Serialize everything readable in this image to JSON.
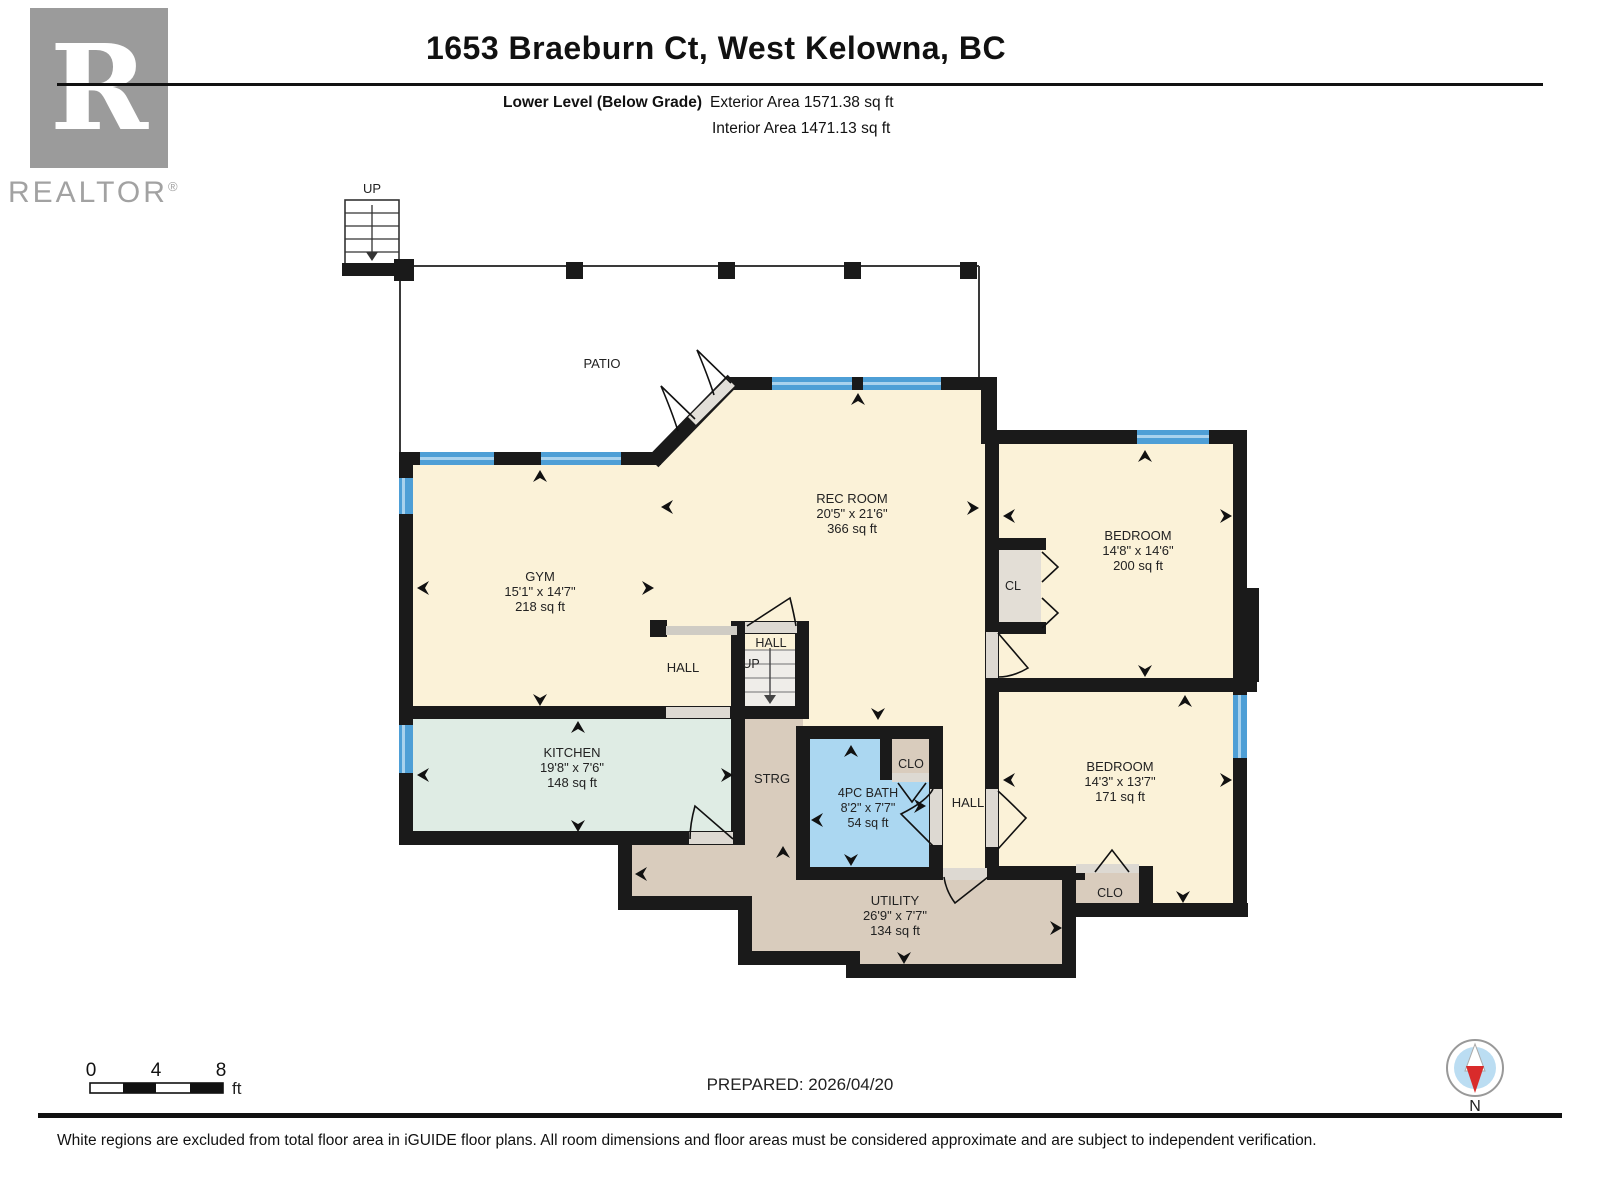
{
  "header": {
    "title": "1653 Braeburn Ct, West Kelowna, BC",
    "level": "Lower Level (Below Grade)",
    "exterior": "Exterior Area 1571.38 sq ft",
    "interior": "Interior Area 1471.13 sq ft"
  },
  "logo": {
    "letter": "R",
    "brand": "REALTOR",
    "registered": "®"
  },
  "plan": {
    "patio": "PATIO",
    "gym": {
      "name": "GYM",
      "dims": "15'1\" x 14'7\"",
      "area": "218 sq ft"
    },
    "rec": {
      "name": "REC ROOM",
      "dims": "20'5\" x 21'6\"",
      "area": "366 sq ft"
    },
    "kitchen": {
      "name": "KITCHEN",
      "dims": "19'8\" x 7'6\"",
      "area": "148 sq ft"
    },
    "bath": {
      "name": "4PC BATH",
      "dims": "8'2\" x 7'7\"",
      "area": "54 sq ft"
    },
    "bedroom1": {
      "name": "BEDROOM",
      "dims": "14'8\" x 14'6\"",
      "area": "200 sq ft"
    },
    "bedroom2": {
      "name": "BEDROOM",
      "dims": "14'3\" x 13'7\"",
      "area": "171 sq ft"
    },
    "utility": {
      "name": "UTILITY",
      "dims": "26'9\" x 7'7\"",
      "area": "134 sq ft"
    },
    "labels": {
      "hall_main": "HALL",
      "hall_stairs": "HALL",
      "hall_bed": "HALL",
      "strg": "STRG",
      "clo_bath": "CLO",
      "clo_bed": "CLO",
      "cl": "CL",
      "up_patio": "UP",
      "up_mid": "UP"
    }
  },
  "scalebar": {
    "t0": "0",
    "t4": "4",
    "t8": "8",
    "unit": "ft"
  },
  "prepared": "PREPARED: 2026/04/20",
  "compass": {
    "north": "N"
  },
  "footer": "White regions are excluded from total floor area in iGUIDE floor plans. All room dimensions and floor areas must be considered approximate and are subject to independent verification.",
  "colors": {
    "cream": "#FBF2D8",
    "mint": "#DFECE4",
    "tan": "#D9CCBD",
    "bath_blue": "#ABD7F1",
    "window_blue": "#4E9FD6",
    "closet_gray": "#E3DED6",
    "wall": "#1A1A1A"
  }
}
